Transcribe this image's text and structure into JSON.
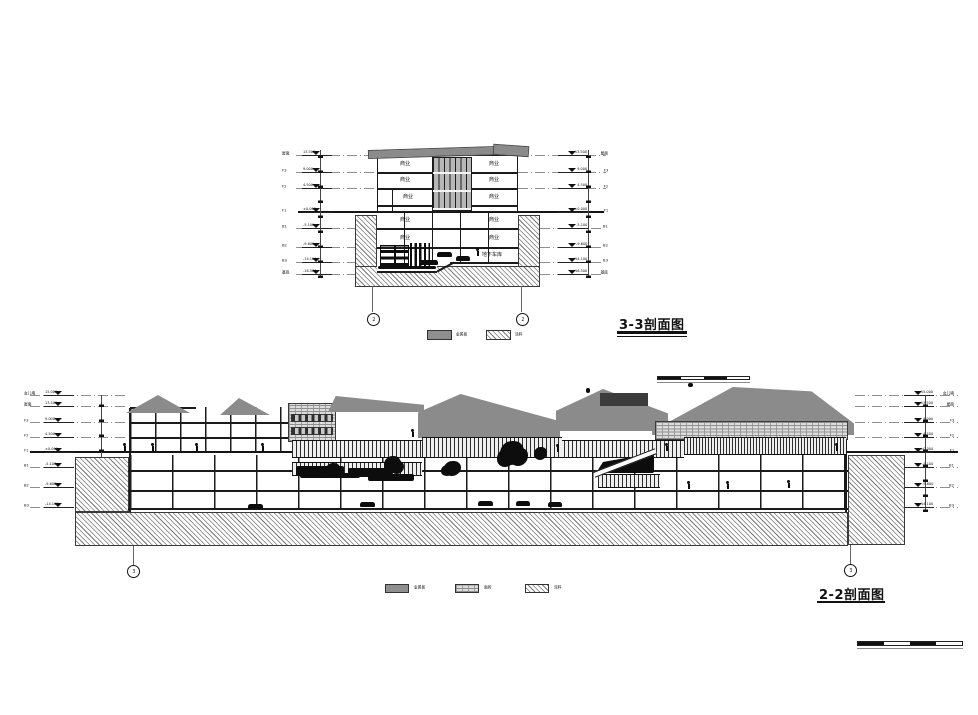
{
  "colors": {
    "roof_gray": "#8b8b8b",
    "ink": "#111111",
    "legend_gray": "#8f8f8f"
  },
  "s33": {
    "title": "3-3剖面图",
    "bubble": "2",
    "levels": [
      {
        "label": "屋面",
        "elev": "13.500"
      },
      {
        "label": "F3",
        "elev": "9.000"
      },
      {
        "label": "F2",
        "elev": "4.500"
      },
      {
        "label": "F1",
        "elev": "±0.000"
      },
      {
        "label": "B1",
        "elev": "-5.100"
      },
      {
        "label": "B2",
        "elev": "-9.600"
      },
      {
        "label": "B3",
        "elev": "-14.100"
      },
      {
        "label": "基底",
        "elev": "-16.500"
      }
    ],
    "rooms_left": [
      "商业",
      "商业",
      "商业",
      "商业",
      "商业"
    ],
    "rooms_right": [
      "商业",
      "商业",
      "商业",
      "商业",
      "商业"
    ],
    "garage": "地下车库",
    "legend": [
      {
        "name": "metal-panel",
        "label": "金属板"
      },
      {
        "name": "paint-hatch",
        "label": "涂料"
      }
    ]
  },
  "s22": {
    "title": "2-2剖面图",
    "bubble": "3",
    "levels": [
      {
        "label": "女儿墙",
        "elev": "15.000"
      },
      {
        "label": "屋面",
        "elev": "13.500"
      },
      {
        "label": "F3",
        "elev": "9.000"
      },
      {
        "label": "F2",
        "elev": "4.500"
      },
      {
        "label": "F1",
        "elev": "±0.000"
      },
      {
        "label": "B1",
        "elev": "-5.100"
      },
      {
        "label": "B2",
        "elev": "-9.600"
      },
      {
        "label": "B3",
        "elev": "-14.100"
      }
    ],
    "legend": [
      {
        "name": "metal-panel",
        "label": "金属板"
      },
      {
        "name": "face-brick",
        "label": "面砖"
      },
      {
        "name": "paint-hatch",
        "label": "涂料"
      }
    ]
  }
}
